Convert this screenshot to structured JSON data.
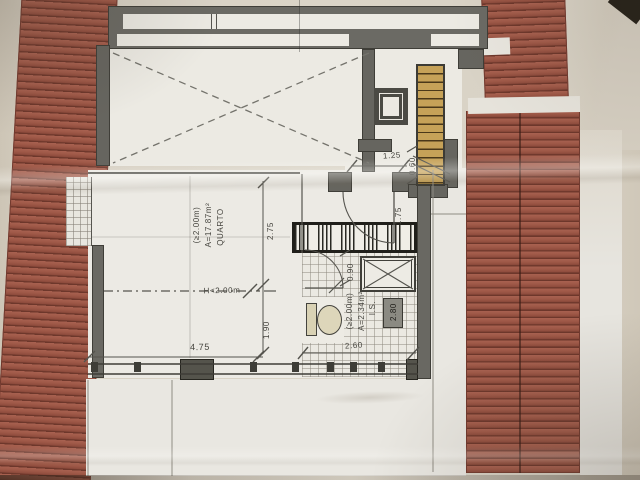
{
  "document": {
    "kind": "architectural floor plan photo",
    "rooms": {
      "bedroom": {
        "name": "QUARTO",
        "area": "A=17.87m²",
        "height_note": "(≥2.00m)"
      },
      "bathroom": {
        "name": "I.S.",
        "area": "A=2.34m²",
        "height_note": "(≥2.00m)"
      }
    },
    "labels": {
      "height_limit": "H<2.00m"
    },
    "dimensions": {
      "bedroom_width": "4.75",
      "bedroom_depth_upper": "2.75",
      "bedroom_depth_lower": "1.90",
      "bathroom_width": "2.60",
      "wall_height": "2.80",
      "shower_width": "0.90",
      "landing_width": "1.25",
      "landing_depth": "0.60",
      "door_passage": "1.75"
    },
    "colors": {
      "roof_tile": "#a05a49",
      "roof_tile_line": "#6d372b",
      "wall_gray": "#6b6a64",
      "paper_beige": "#d8d1c4",
      "sheet_white": "#eceae4",
      "stair_wood": "#c6a258",
      "ink": "#55544e"
    }
  }
}
